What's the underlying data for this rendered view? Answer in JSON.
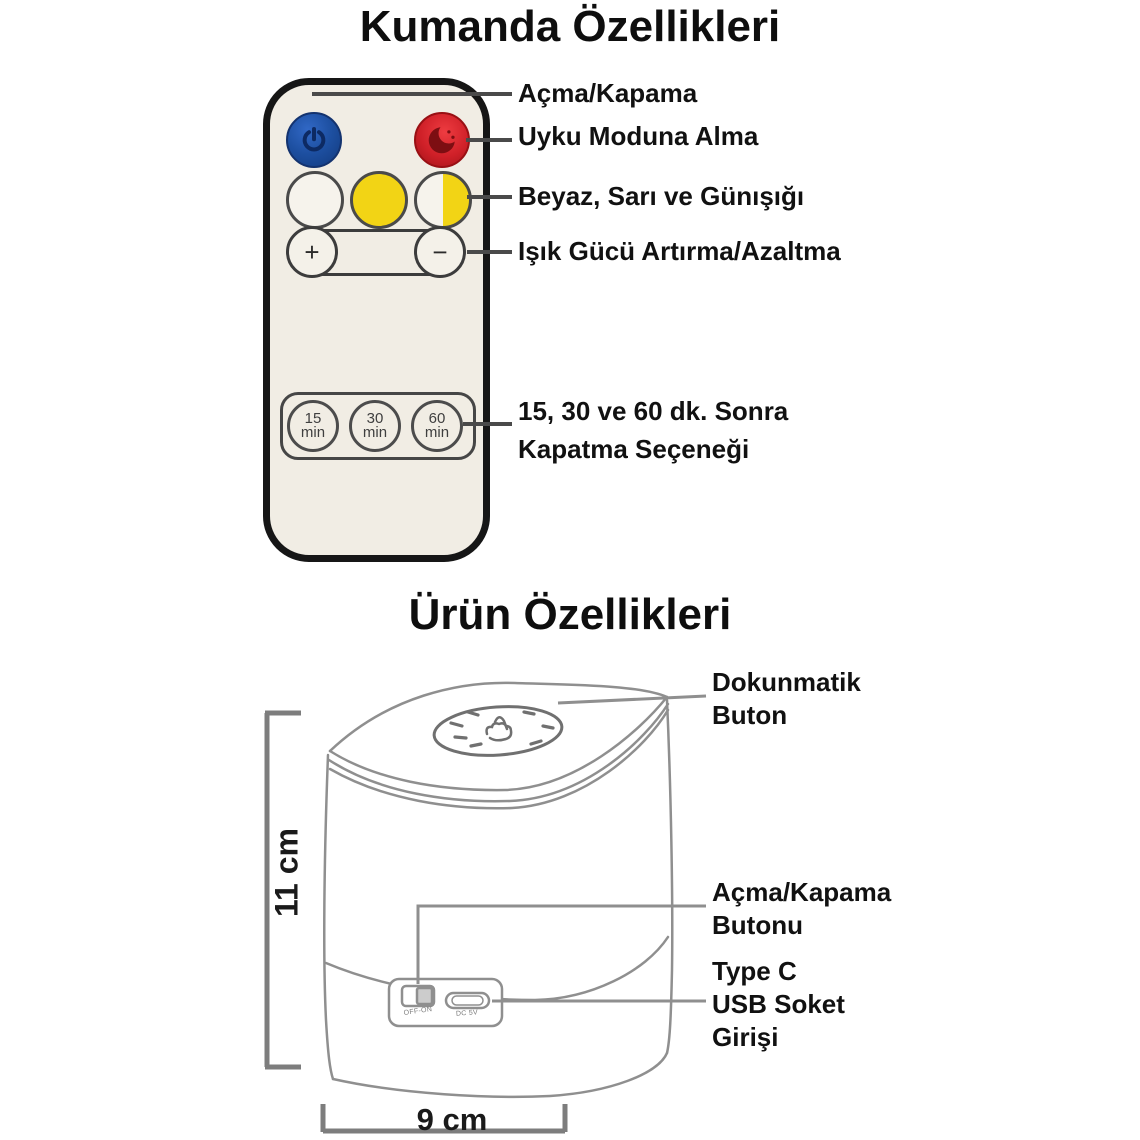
{
  "remote_section": {
    "title": "Kumanda Özellikleri",
    "labels": {
      "power": "Açma/Kapama",
      "sleep": "Uyku Moduna Alma",
      "light_colors": "Beyaz, Sarı ve Günışığı",
      "brightness": "Işık Gücü Artırma/Azaltma",
      "timer_line1": "15, 30 ve 60 dk. Sonra",
      "timer_line2": "Kapatma Seçeneği"
    },
    "remote": {
      "plus": "+",
      "minus": "−",
      "timers": [
        {
          "value": "15",
          "unit": "min"
        },
        {
          "value": "30",
          "unit": "min"
        },
        {
          "value": "60",
          "unit": "min"
        }
      ],
      "icons": {
        "power": "power-icon",
        "sleep": "moon-icon"
      }
    }
  },
  "product_section": {
    "title": "Ürün Özellikleri",
    "labels": {
      "touch_line1": "Dokunmatik",
      "touch_line2": "Buton",
      "power_line1": "Açma/Kapama",
      "power_line2": "Butonu",
      "usb_line1": "Type C",
      "usb_line2": "USB Soket",
      "usb_line3": "Girişi"
    },
    "device": {
      "switch_label": "OFF-ON",
      "usb_label": "DC 5V",
      "touch_icon": "touch-hand-icon"
    },
    "dimensions": {
      "height": "11 cm",
      "width": "9 cm"
    }
  },
  "colors": {
    "background": "#ffffff",
    "remote_body": "#f1ede4",
    "power_button_blue": "#1d4fa0",
    "sleep_button_red": "#cf2028",
    "yellow_button": "#f2d415",
    "white_button": "#f6f3ec",
    "label_text": "#111111",
    "callout_line": "#4a4a4a",
    "line_art": "#8f8f8f"
  }
}
